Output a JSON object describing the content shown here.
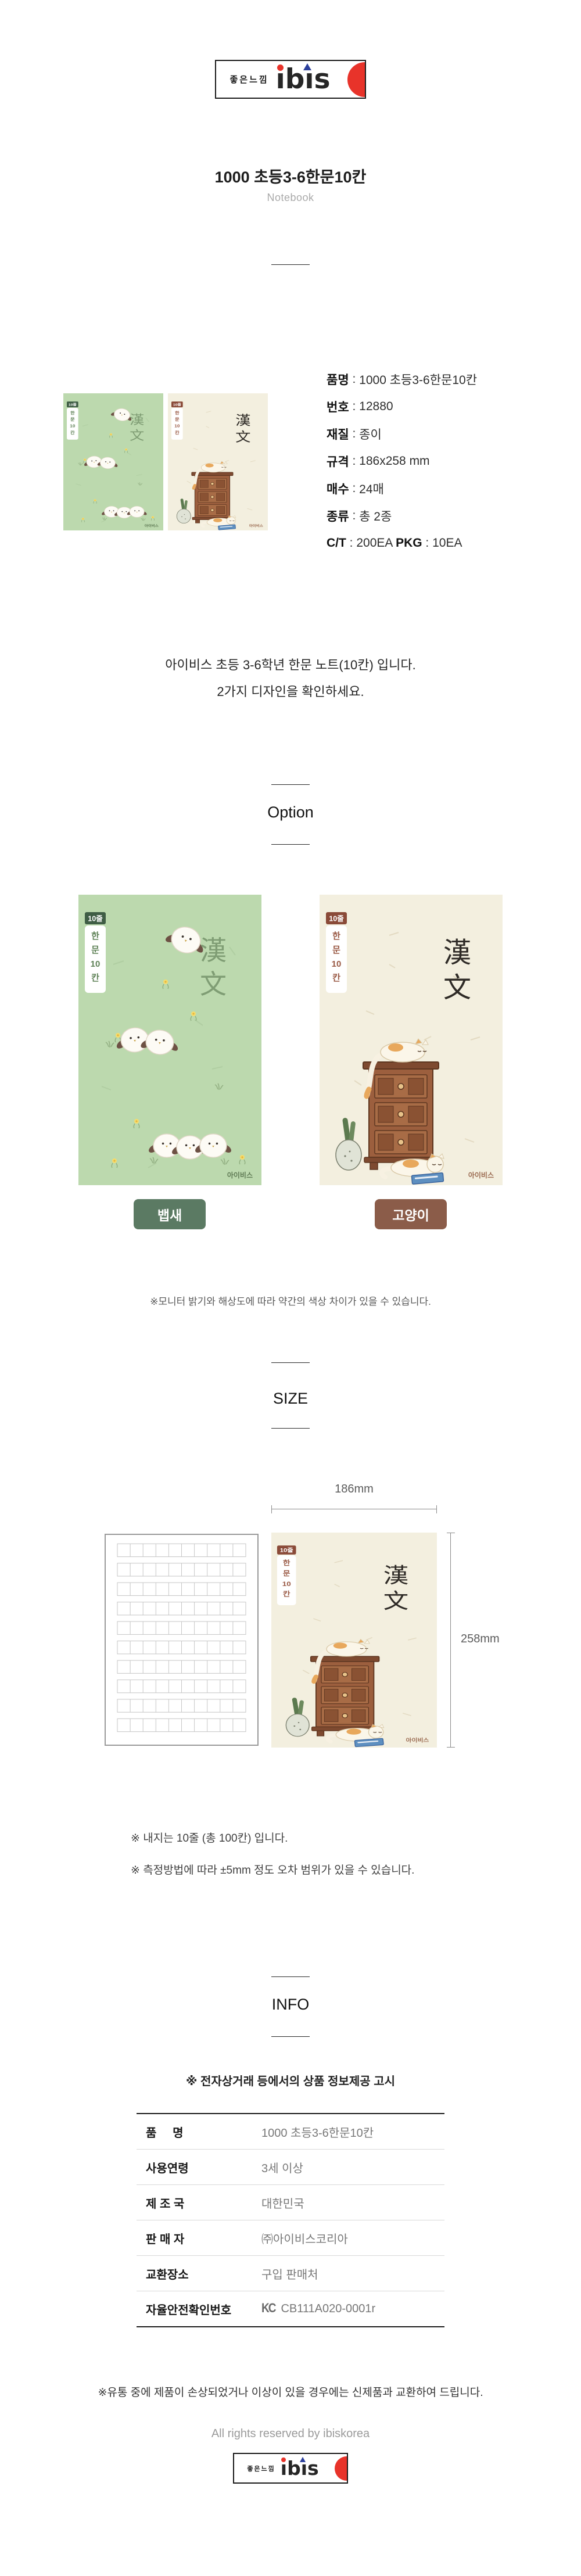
{
  "punct": {
    "colon": " : "
  },
  "brand": {
    "korean": "좋은느낌",
    "name": "ibis",
    "name_display": "ıbıs",
    "accent_red": "#e8332a",
    "accent_blue": "#2b3f9c"
  },
  "header": {
    "title": "1000 초등3-6한문10칸",
    "subtitle": "Notebook"
  },
  "specs": {
    "rows": [
      {
        "label": "품명",
        "value": "1000 초등3-6한문10칸"
      },
      {
        "label": "번호",
        "value": "12880"
      },
      {
        "label": "재질",
        "value": "종이"
      },
      {
        "label": "규격",
        "value": "186x258 mm"
      },
      {
        "label": "매수",
        "value": "24매"
      },
      {
        "label": "종류",
        "value": "총 2종"
      }
    ],
    "ct": {
      "label": "C/T",
      "value": "200EA ",
      "pkg_label": "PKG",
      "pkg_value": "10EA"
    }
  },
  "description": {
    "line1": "아이비스 초등 3-6학년 한문 노트(10칸) 입니다.",
    "line2": "2가지 디자인을 확인하세요."
  },
  "sections": {
    "option": "Option",
    "size": "SIZE",
    "info": "INFO"
  },
  "covers": {
    "badge": "10줄",
    "tab": [
      "한",
      "문",
      "10",
      "칸"
    ],
    "hanja": [
      "漢",
      "文"
    ],
    "brand": "아이비스",
    "bird": {
      "label": "뱁새",
      "bg": "#bcd9ae",
      "label_bg": "#5b7a63"
    },
    "cat": {
      "label": "고양이",
      "bg": "#f3efdf",
      "label_bg": "#8b5c49"
    }
  },
  "option_note": "※모니터 밝기와 해상도에 따라 약간의 색상 차이가 있을 수 있습니다.",
  "size": {
    "width": "186mm",
    "height": "258mm",
    "note1": "※ 내지는 10줄 (총 100칸) 입니다.",
    "note2": "※ 측정방법에 따라 ±5mm 정도 오차 범위가 있을 수 있습니다."
  },
  "info": {
    "notice": "※ 전자상거래 등에서의 상품 정보제공 고시",
    "rows": [
      {
        "label": "품     명",
        "value": "1000 초등3-6한문10칸"
      },
      {
        "label": "사용연령",
        "value": "3세 이상"
      },
      {
        "label": "제 조 국",
        "value": "대한민국"
      },
      {
        "label": "판 매 자",
        "value": "㈜아이비스코리아"
      },
      {
        "label": "교환장소",
        "value": "구입 판매처"
      },
      {
        "label": "자율안전확인번호",
        "value": "CB111A020-0001r"
      }
    ]
  },
  "icons": {
    "kc": "KC"
  },
  "footer": {
    "note": "※유통 중에 제품이 손상되었거나 이상이 있을 경우에는 신제품과 교환하여 드립니다.",
    "rights": "All rights reserved by ibiskorea"
  }
}
